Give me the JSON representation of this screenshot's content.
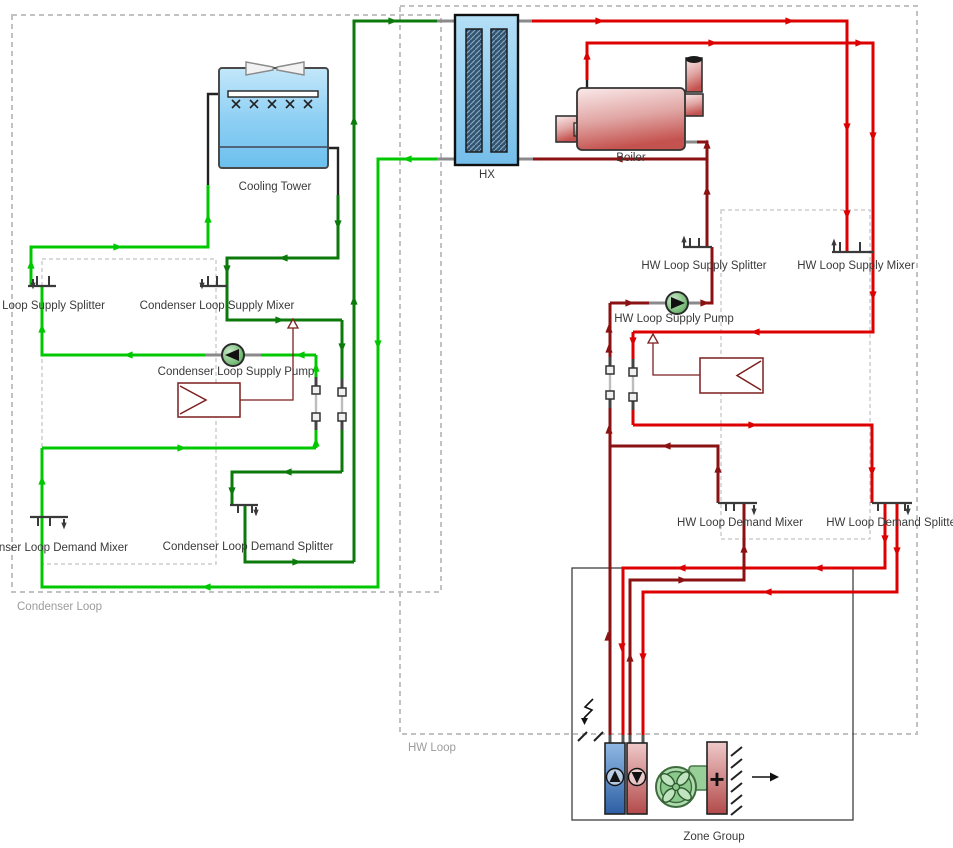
{
  "colors": {
    "condenser_supply": "#00C800",
    "condenser_return": "#0B7A0B",
    "hw_supply": "#DD0000",
    "hw_return": "#8B1212",
    "control_line": "#7B1F1F",
    "boundary_dash": "#C2C2C2",
    "component_stroke": "#3A3A3A"
  },
  "loops": [
    {
      "id": "condenser-loop",
      "label": "Condenser Loop"
    },
    {
      "id": "hw-loop",
      "label": "HW Loop"
    }
  ],
  "components": {
    "cooling_tower": "Cooling Tower",
    "hx": "HX",
    "boiler": "Boiler",
    "condenser_supply_splitter": "Condenser Loop Supply Splitter",
    "condenser_supply_mixer": "Condenser Loop Supply Mixer",
    "condenser_supply_pump": "Condenser Loop Supply Pump",
    "condenser_demand_mixer": "Condenser Loop Demand Mixer",
    "condenser_demand_splitter": "Condenser Loop Demand Splitter",
    "hw_supply_splitter": "HW Loop Supply Splitter",
    "hw_supply_mixer": "HW Loop Supply Mixer",
    "hw_supply_pump": "HW Loop Supply Pump",
    "hw_demand_mixer": "HW Loop Demand Mixer",
    "hw_demand_splitter": "HW Loop Demand Splitter",
    "zone_group": "Zone Group"
  },
  "zone": {
    "heater_symbol": "+"
  },
  "icons": {
    "pump-icon": "filled triangle in green circle",
    "fan-icon": "green swirl fan",
    "cooling-coil-icon": "blue bar with up triangle",
    "heating-coil-icon": "red bar with down triangle",
    "electric-heater-icon": "+",
    "lightning-icon": "zigzag arrow",
    "setpoint-arrow-icon": "hollow triangle"
  },
  "labels": [
    {
      "id": "cooling-tower-label",
      "text": "Cooling Tower",
      "x": 275,
      "y": 190,
      "anchor": "middle",
      "cls": "comp-label"
    },
    {
      "id": "hx-label",
      "text": "HX",
      "x": 487,
      "y": 178,
      "anchor": "middle",
      "cls": "comp-label"
    },
    {
      "id": "boiler-label",
      "text": "Boiler",
      "x": 631,
      "y": 161,
      "anchor": "middle",
      "cls": "comp-label"
    },
    {
      "id": "cl-supply-splitter-label",
      "text": "Condenser Loop Supply Splitter",
      "x": 105,
      "y": 309,
      "anchor": "end",
      "cls": "comp-label"
    },
    {
      "id": "cl-supply-mixer-label",
      "text": "Condenser Loop Supply Mixer",
      "x": 217,
      "y": 309,
      "anchor": "middle",
      "cls": "comp-label"
    },
    {
      "id": "cl-supply-pump-label",
      "text": "Condenser Loop Supply Pump",
      "x": 236,
      "y": 375,
      "anchor": "middle",
      "cls": "comp-label"
    },
    {
      "id": "cl-demand-mixer-label",
      "text": "Condenser Loop Demand Mixer",
      "x": 128,
      "y": 551,
      "anchor": "end",
      "cls": "comp-label"
    },
    {
      "id": "cl-demand-splitter-label",
      "text": "Condenser Loop Demand Splitter",
      "x": 248,
      "y": 550,
      "anchor": "middle",
      "cls": "comp-label"
    },
    {
      "id": "condenser-loop-label",
      "text": "Condenser Loop",
      "x": 17,
      "y": 610,
      "anchor": "start",
      "cls": "loop-label"
    },
    {
      "id": "hw-supply-splitter-label",
      "text": "HW Loop Supply Splitter",
      "x": 704,
      "y": 269,
      "anchor": "middle",
      "cls": "comp-label"
    },
    {
      "id": "hw-supply-mixer-label",
      "text": "HW Loop Supply Mixer",
      "x": 856,
      "y": 269,
      "anchor": "middle",
      "cls": "comp-label"
    },
    {
      "id": "hw-supply-pump-label",
      "text": "HW Loop Supply Pump",
      "x": 674,
      "y": 322,
      "anchor": "middle",
      "cls": "comp-label"
    },
    {
      "id": "hw-demand-mixer-label",
      "text": "HW Loop Demand Mixer",
      "x": 740,
      "y": 526,
      "anchor": "middle",
      "cls": "comp-label"
    },
    {
      "id": "hw-demand-splitter-label",
      "text": "HW Loop Demand Splitter",
      "x": 893,
      "y": 526,
      "anchor": "middle",
      "cls": "comp-label"
    },
    {
      "id": "hw-loop-label",
      "text": "HW Loop",
      "x": 408,
      "y": 751,
      "anchor": "start",
      "cls": "loop-label"
    },
    {
      "id": "zone-group-label",
      "text": "Zone Group",
      "x": 714,
      "y": 840,
      "anchor": "middle",
      "cls": "comp-label"
    }
  ]
}
